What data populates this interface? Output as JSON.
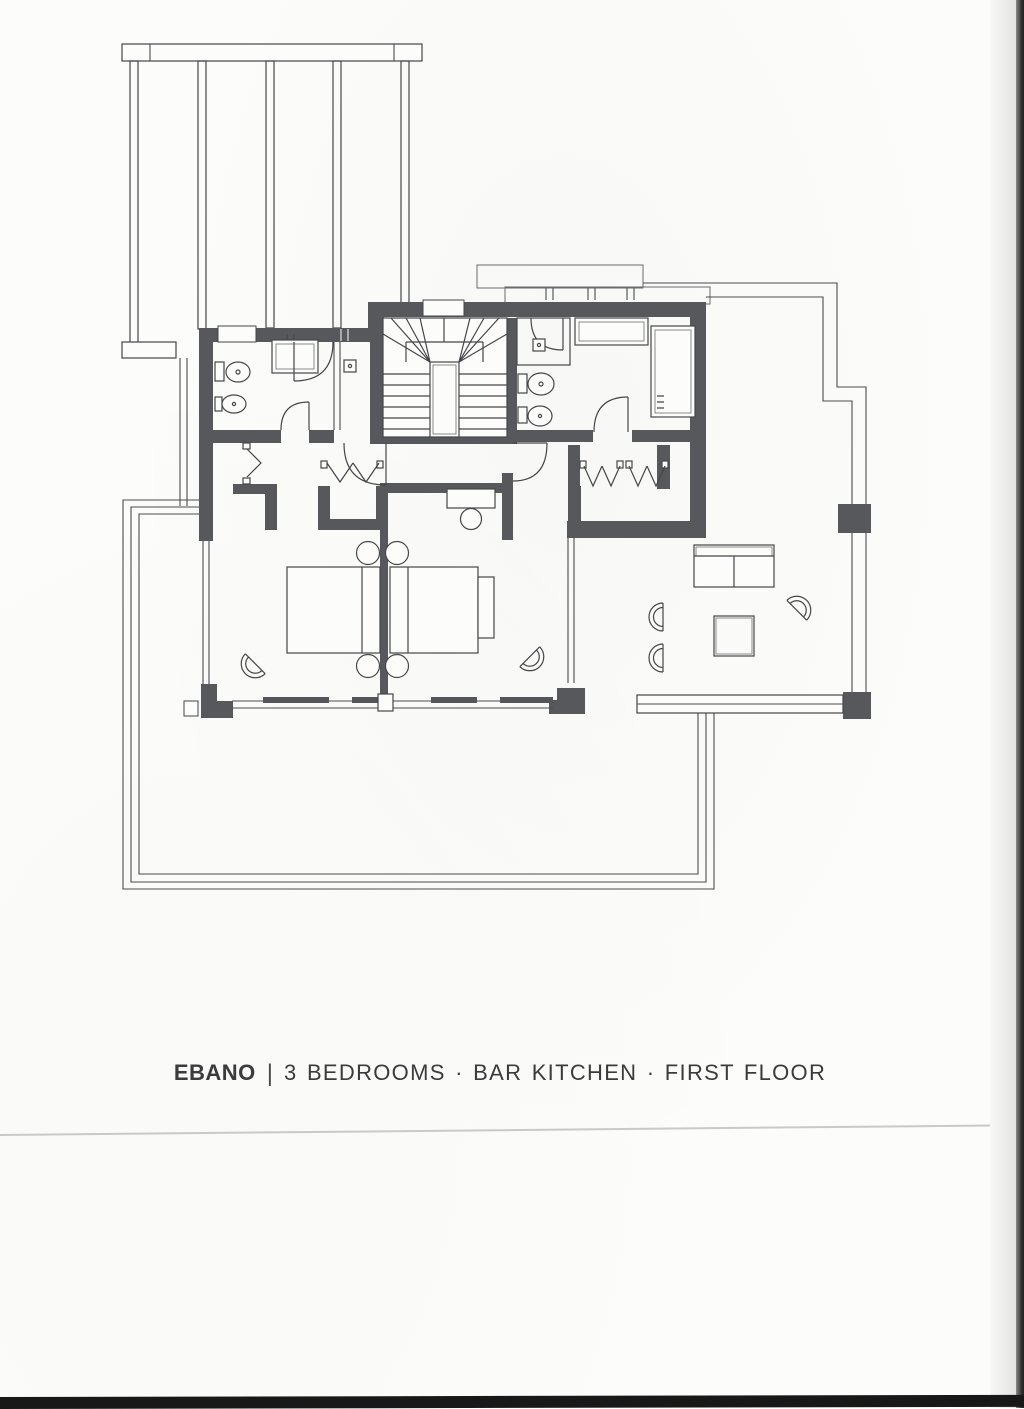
{
  "caption": {
    "project_name": "EBANO",
    "separator": "|",
    "description": "3 BEDROOMS · BAR KITCHEN · FIRST FLOOR"
  },
  "colors": {
    "paper": "#fcfcfa",
    "plan_ink": "#45464a",
    "wall_fill": "#57585b",
    "caption_text": "#3a3b3d",
    "scan_faint_line": "#c9c9c6",
    "scan_edge_dark": "#2f2f2d",
    "scan_bottom_band": "#181818"
  }
}
